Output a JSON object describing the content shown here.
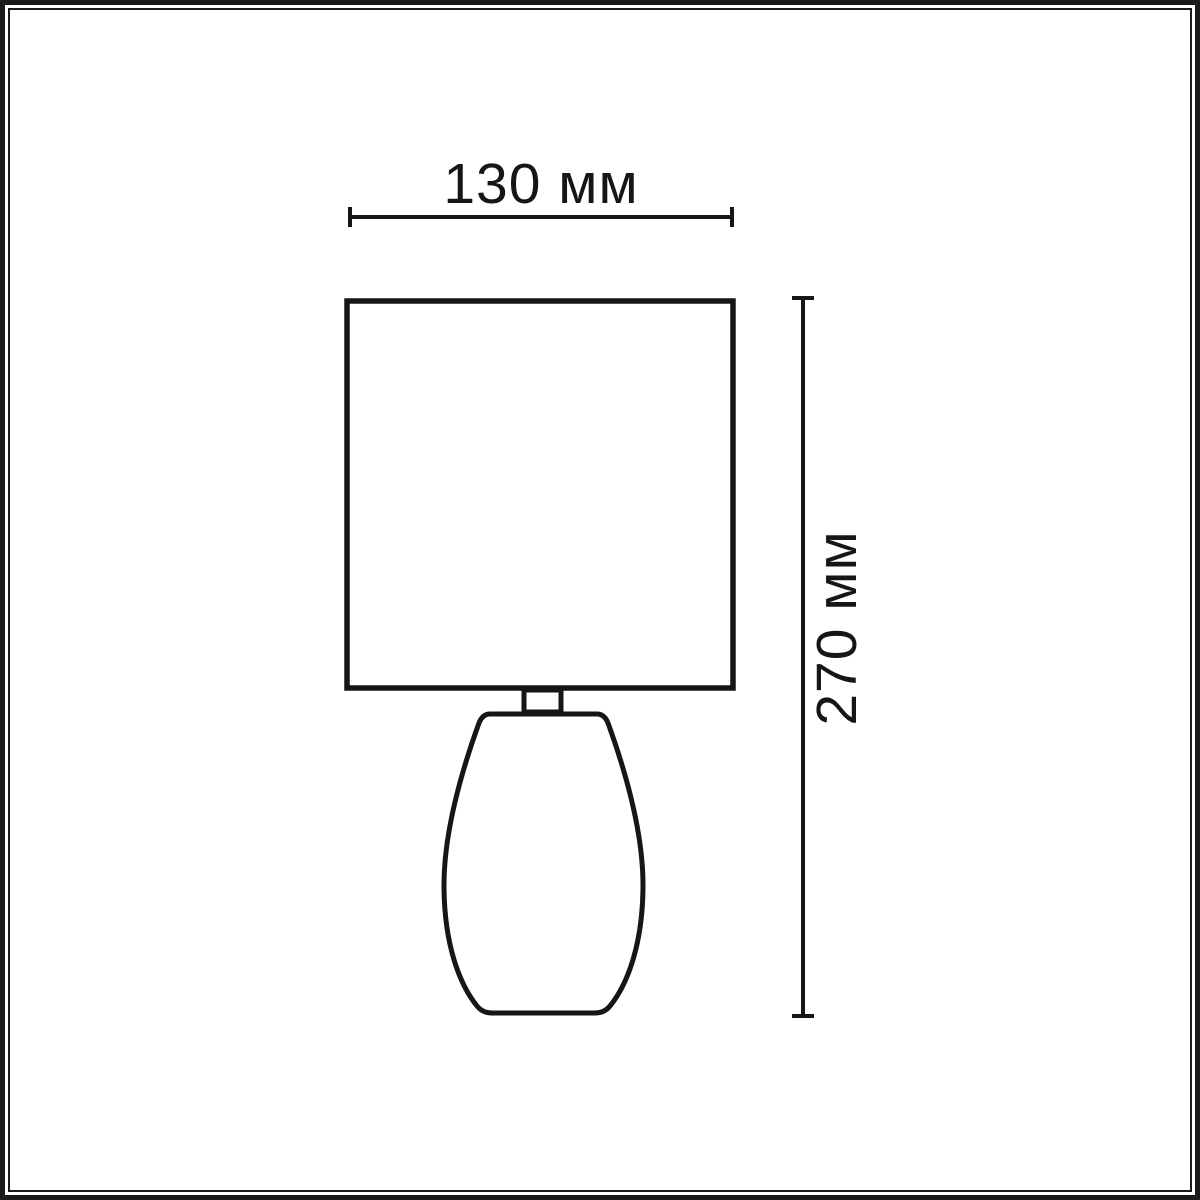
{
  "diagram": {
    "kind": "lamp-dimension-drawing",
    "background_color": "#ffffff",
    "line_color": "#161616",
    "frame_color": "#1b1b1b",
    "dimensions": {
      "width": {
        "label": "130 мм",
        "value_mm": 130
      },
      "height": {
        "label": "270 мм",
        "value_mm": 270
      }
    }
  }
}
